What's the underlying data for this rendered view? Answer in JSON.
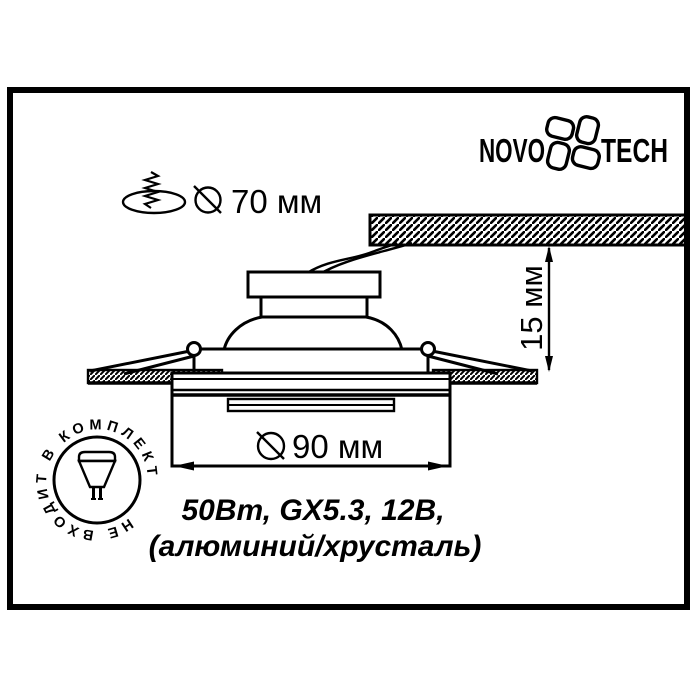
{
  "frame": {
    "border_color": "#000000",
    "background": "#ffffff"
  },
  "logo": {
    "left": "NOVO",
    "right": "TECH",
    "mark": "four-petal-pinwheel"
  },
  "dimensions": {
    "cutout": {
      "symbol": "circle-with-slash",
      "value": "70 мм"
    },
    "trim": {
      "symbol": "circle-with-slash",
      "value": "90 мм"
    },
    "depth": {
      "value": "15 мм"
    }
  },
  "specs": {
    "line1": "50Вт, GX5.3, 12В,",
    "line2": "(алюминий/хрусталь)"
  },
  "stamp": {
    "text": "НЕ ВХОДИТ В КОМПЛЕКТ",
    "icon": "mr16-halogen-lamp"
  },
  "icons": {
    "mounting_hole": "ceiling-cutout-with-screw",
    "diameter_sign": "circle-with-slash"
  },
  "drawing": {
    "parts": [
      "ceiling-slab",
      "power-wires",
      "lamp-housing",
      "lamp-dome",
      "mounting-plate",
      "spring-clips",
      "false-ceiling-strips",
      "trim-ring",
      "glass-diffuser"
    ],
    "line_color": "#000000",
    "fill_color": "#ffffff"
  }
}
